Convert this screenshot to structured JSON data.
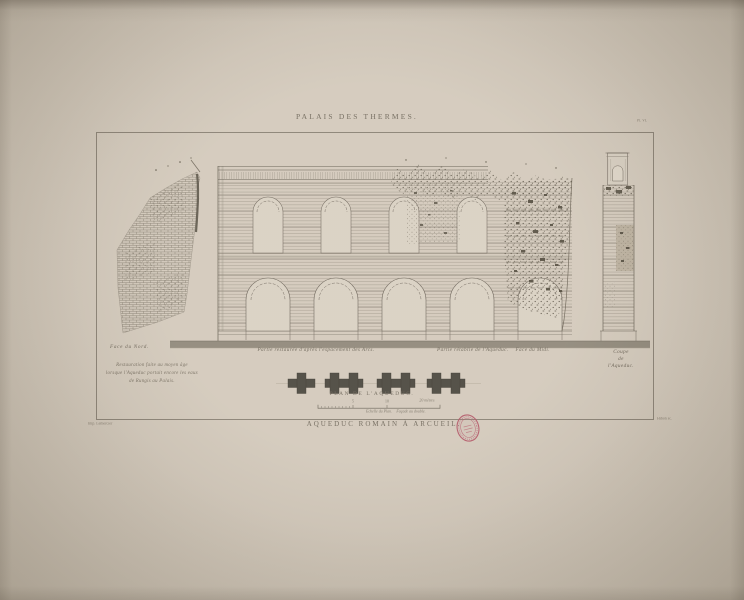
{
  "plate": {
    "series_title": "PALAIS DES THERMES.",
    "plate_number": "Pl. VI.",
    "bottom_title": "AQUEDUC ROMAIN À ARCUEIL."
  },
  "labels": {
    "face_du_nord": "Face du Nord.",
    "restoration_note": [
      "Restauration faite au moyen âge",
      "lorsque l'Aqueduc portait encore les eaux",
      "de Rungis au Palais."
    ],
    "partie_restauree": "Partie restaurée d'après l'espacement des Arcs.",
    "partie_retablie": "Partie rétablie de l'Aqueduc.",
    "face_du_midi": "Face du Midi.",
    "coupe": [
      "Coupe",
      "de",
      "l'Aqueduc."
    ],
    "plan_title": "PLAN DE L'AQUEDUC.",
    "scale": {
      "tick_5": "5",
      "tick_10": "10",
      "end_label": "20 mètres",
      "caption_left": "Echelle du Plan.",
      "caption_right": "Façade au double."
    },
    "credit_left": "Imp. Lemercier",
    "credit_right": "Hibon sc."
  },
  "stamp": {
    "description": "red oval collection stamp"
  },
  "colors": {
    "backdrop": "#c7bdad",
    "paper": "#d2c8ba",
    "paper_light": "#d9d0c2",
    "ink": "#5f574b",
    "ink_soft": "#9a9183",
    "text": "#6e6558",
    "ground": "#8e8678",
    "pier": "#48443b",
    "stamp_red": "#b04f61",
    "frame": "#7b7265"
  }
}
